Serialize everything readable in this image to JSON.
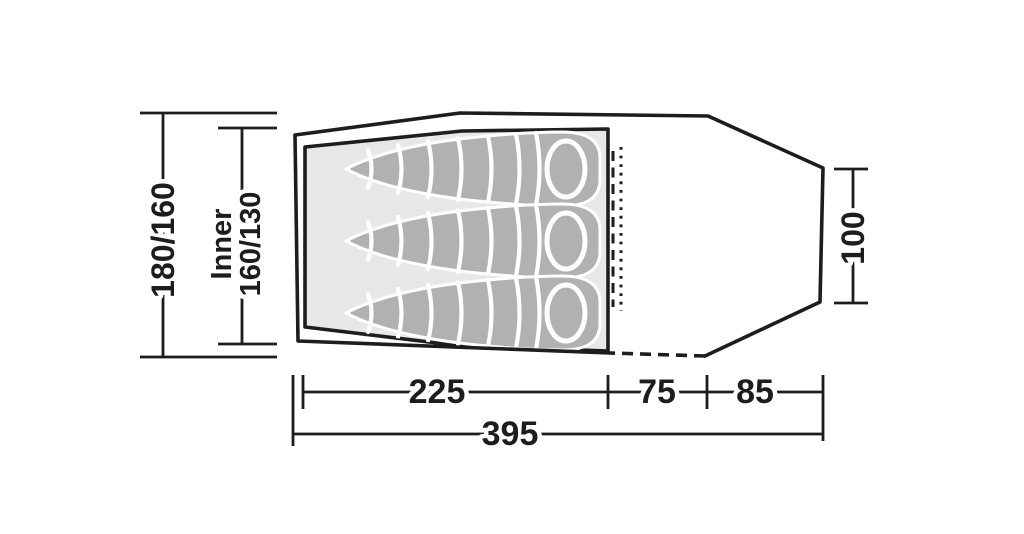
{
  "diagram": {
    "kind": "tent-floor-plan",
    "occupants": 3,
    "colors": {
      "line": "#1d1d1b",
      "inner_fill": "#e7e7e6",
      "bag_fill": "#b1b1b1",
      "background": "#ffffff"
    },
    "dimensions": {
      "left_outer": "180/160",
      "inner_label": "Inner",
      "inner_value": "160/130",
      "right_depth": "100",
      "inner_length": "225",
      "mid_length": "75",
      "end_length": "85",
      "total_length": "395"
    }
  }
}
